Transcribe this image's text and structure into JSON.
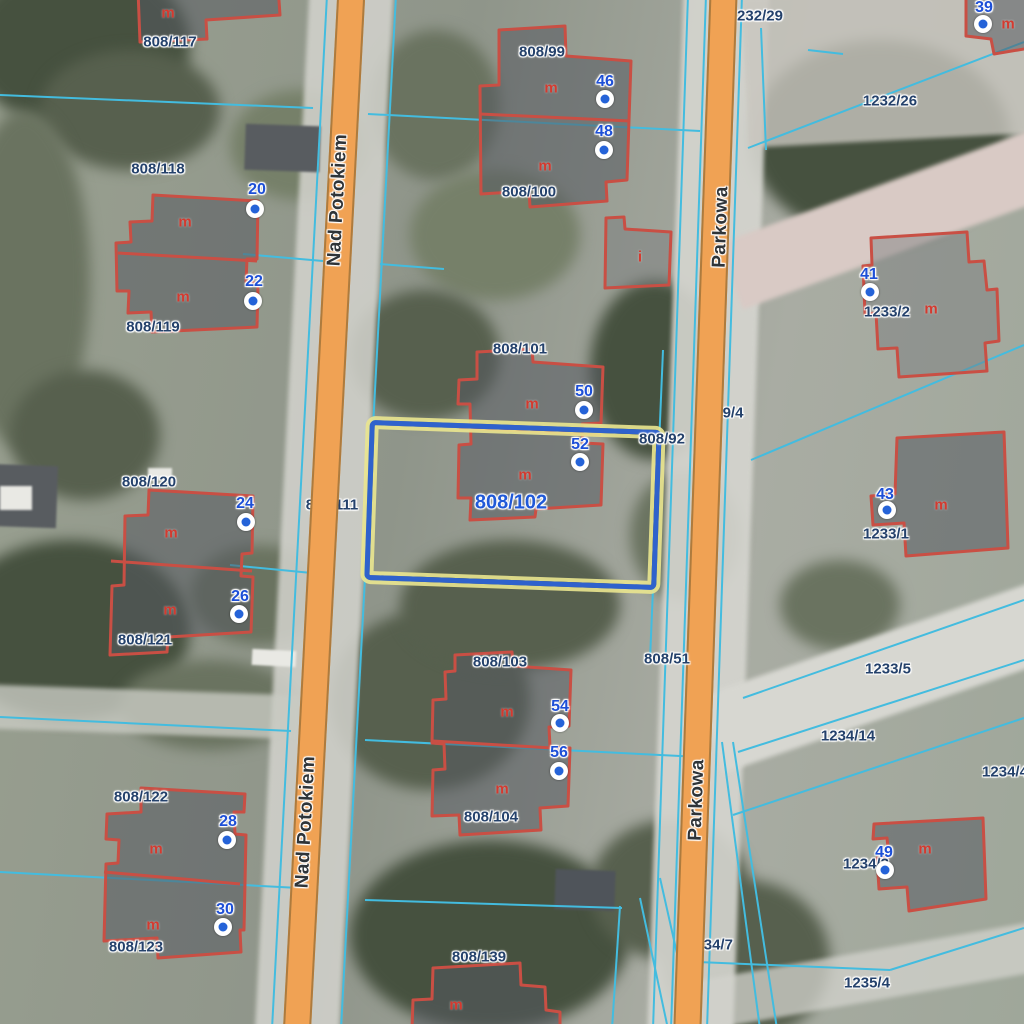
{
  "map": {
    "type": "cadastral-orthophoto-viewer",
    "colors": {
      "road_fill": "#f0a254",
      "road_edge": "#ad7b3e",
      "parcel_boundary_line": "#43bcdf",
      "building_outline": "#c94f44",
      "parcel_label": "#24416b",
      "address_label": "#1d4fd7",
      "selected_parcel_label": "#2059d8",
      "building_letter": "#d43a2f",
      "street_label": "#2f3438",
      "selection_border": "#2f62cc",
      "selection_glow": "#eae68f"
    },
    "icons": {
      "address_marker": "white-circle-blue-dot"
    },
    "streets": [
      {
        "name": "Nad Potokiem",
        "x": 338,
        "y": 200,
        "rot": -87
      },
      {
        "name": "Nad Potokiem",
        "x": 306,
        "y": 822,
        "rot": -87
      },
      {
        "name": "Parkowa",
        "x": 721,
        "y": 227,
        "rot": -88
      },
      {
        "name": "Parkowa",
        "x": 697,
        "y": 800,
        "rot": -88
      }
    ],
    "selected_parcel": {
      "id": "808/102",
      "label_x": 511,
      "label_y": 503,
      "box": {
        "left": 367,
        "top": 425,
        "width": 292,
        "height": 160,
        "rot": 2
      }
    },
    "parcel_labels": [
      {
        "text": "808/117",
        "x": 170,
        "y": 42
      },
      {
        "text": "808/118",
        "x": 158,
        "y": 169
      },
      {
        "text": "808/119",
        "x": 153,
        "y": 327
      },
      {
        "text": "808/120",
        "x": 149,
        "y": 482
      },
      {
        "text": "808/121",
        "x": 145,
        "y": 640
      },
      {
        "text": "808/122",
        "x": 141,
        "y": 797
      },
      {
        "text": "808/123",
        "x": 136,
        "y": 947
      },
      {
        "text": "808/99",
        "x": 542,
        "y": 52
      },
      {
        "text": "808/100",
        "x": 529,
        "y": 192
      },
      {
        "text": "808/101",
        "x": 520,
        "y": 349
      },
      {
        "text": "808/92",
        "x": 662,
        "y": 439
      },
      {
        "text": "808/103",
        "x": 500,
        "y": 662
      },
      {
        "text": "808/104",
        "x": 491,
        "y": 817
      },
      {
        "text": "808/139",
        "x": 479,
        "y": 957
      },
      {
        "text": "808/51",
        "x": 667,
        "y": 659
      },
      {
        "text": "1232/26",
        "x": 890,
        "y": 101
      },
      {
        "text": "1233/2",
        "x": 887,
        "y": 312
      },
      {
        "text": "1233/1",
        "x": 886,
        "y": 534
      },
      {
        "text": "1233/5",
        "x": 888,
        "y": 669
      },
      {
        "text": "1234/14",
        "x": 848,
        "y": 736
      },
      {
        "text": "1234/4",
        "x": 1005,
        "y": 772
      },
      {
        "text": "1234/3",
        "x": 866,
        "y": 864
      },
      {
        "text": "1235/4",
        "x": 867,
        "y": 983
      }
    ],
    "parcel_labels_under_roads": [
      {
        "text": "232/29",
        "x": 760,
        "y": 16
      },
      {
        "text": "9/4",
        "x": 733,
        "y": 413
      },
      {
        "text": "808/111",
        "x": 332,
        "y": 505
      },
      {
        "text": "1234/7",
        "x": 710,
        "y": 945
      }
    ],
    "address_points": [
      {
        "number": "20",
        "lx": 257,
        "ly": 190,
        "mx": 255,
        "my": 209
      },
      {
        "number": "22",
        "lx": 254,
        "ly": 282,
        "mx": 253,
        "my": 301
      },
      {
        "number": "24",
        "lx": 245,
        "ly": 504,
        "mx": 246,
        "my": 522
      },
      {
        "number": "26",
        "lx": 240,
        "ly": 597,
        "mx": 239,
        "my": 614
      },
      {
        "number": "28",
        "lx": 228,
        "ly": 822,
        "mx": 227,
        "my": 840
      },
      {
        "number": "30",
        "lx": 225,
        "ly": 910,
        "mx": 223,
        "my": 927
      },
      {
        "number": "46",
        "lx": 605,
        "ly": 82,
        "mx": 605,
        "my": 99
      },
      {
        "number": "48",
        "lx": 604,
        "ly": 132,
        "mx": 604,
        "my": 150
      },
      {
        "number": "50",
        "lx": 584,
        "ly": 392,
        "mx": 584,
        "my": 410
      },
      {
        "number": "52",
        "lx": 580,
        "ly": 445,
        "mx": 580,
        "my": 462
      },
      {
        "number": "54",
        "lx": 560,
        "ly": 707,
        "mx": 560,
        "my": 723
      },
      {
        "number": "56",
        "lx": 559,
        "ly": 753,
        "mx": 559,
        "my": 771
      },
      {
        "number": "39",
        "lx": 984,
        "ly": 8,
        "mx": 983,
        "my": 24
      },
      {
        "number": "41",
        "lx": 869,
        "ly": 275,
        "mx": 870,
        "my": 292
      },
      {
        "number": "43",
        "lx": 885,
        "ly": 495,
        "mx": 887,
        "my": 510
      },
      {
        "number": "49",
        "lx": 884,
        "ly": 853,
        "mx": 885,
        "my": 870
      }
    ],
    "building_function_labels": [
      {
        "text": "m",
        "x": 168,
        "y": 13
      },
      {
        "text": "m",
        "x": 185,
        "y": 222
      },
      {
        "text": "m",
        "x": 183,
        "y": 297
      },
      {
        "text": "m",
        "x": 171,
        "y": 533
      },
      {
        "text": "m",
        "x": 170,
        "y": 610
      },
      {
        "text": "m",
        "x": 156,
        "y": 849
      },
      {
        "text": "m",
        "x": 153,
        "y": 925
      },
      {
        "text": "m",
        "x": 551,
        "y": 88
      },
      {
        "text": "m",
        "x": 545,
        "y": 166
      },
      {
        "text": "m",
        "x": 532,
        "y": 404
      },
      {
        "text": "m",
        "x": 525,
        "y": 475
      },
      {
        "text": "m",
        "x": 507,
        "y": 712
      },
      {
        "text": "m",
        "x": 502,
        "y": 789
      },
      {
        "text": "m",
        "x": 456,
        "y": 1005
      },
      {
        "text": "m",
        "x": 1008,
        "y": 24
      },
      {
        "text": "m",
        "x": 931,
        "y": 309
      },
      {
        "text": "m",
        "x": 941,
        "y": 505
      },
      {
        "text": "m",
        "x": 925,
        "y": 849
      },
      {
        "text": "i",
        "x": 640,
        "y": 257
      }
    ]
  }
}
